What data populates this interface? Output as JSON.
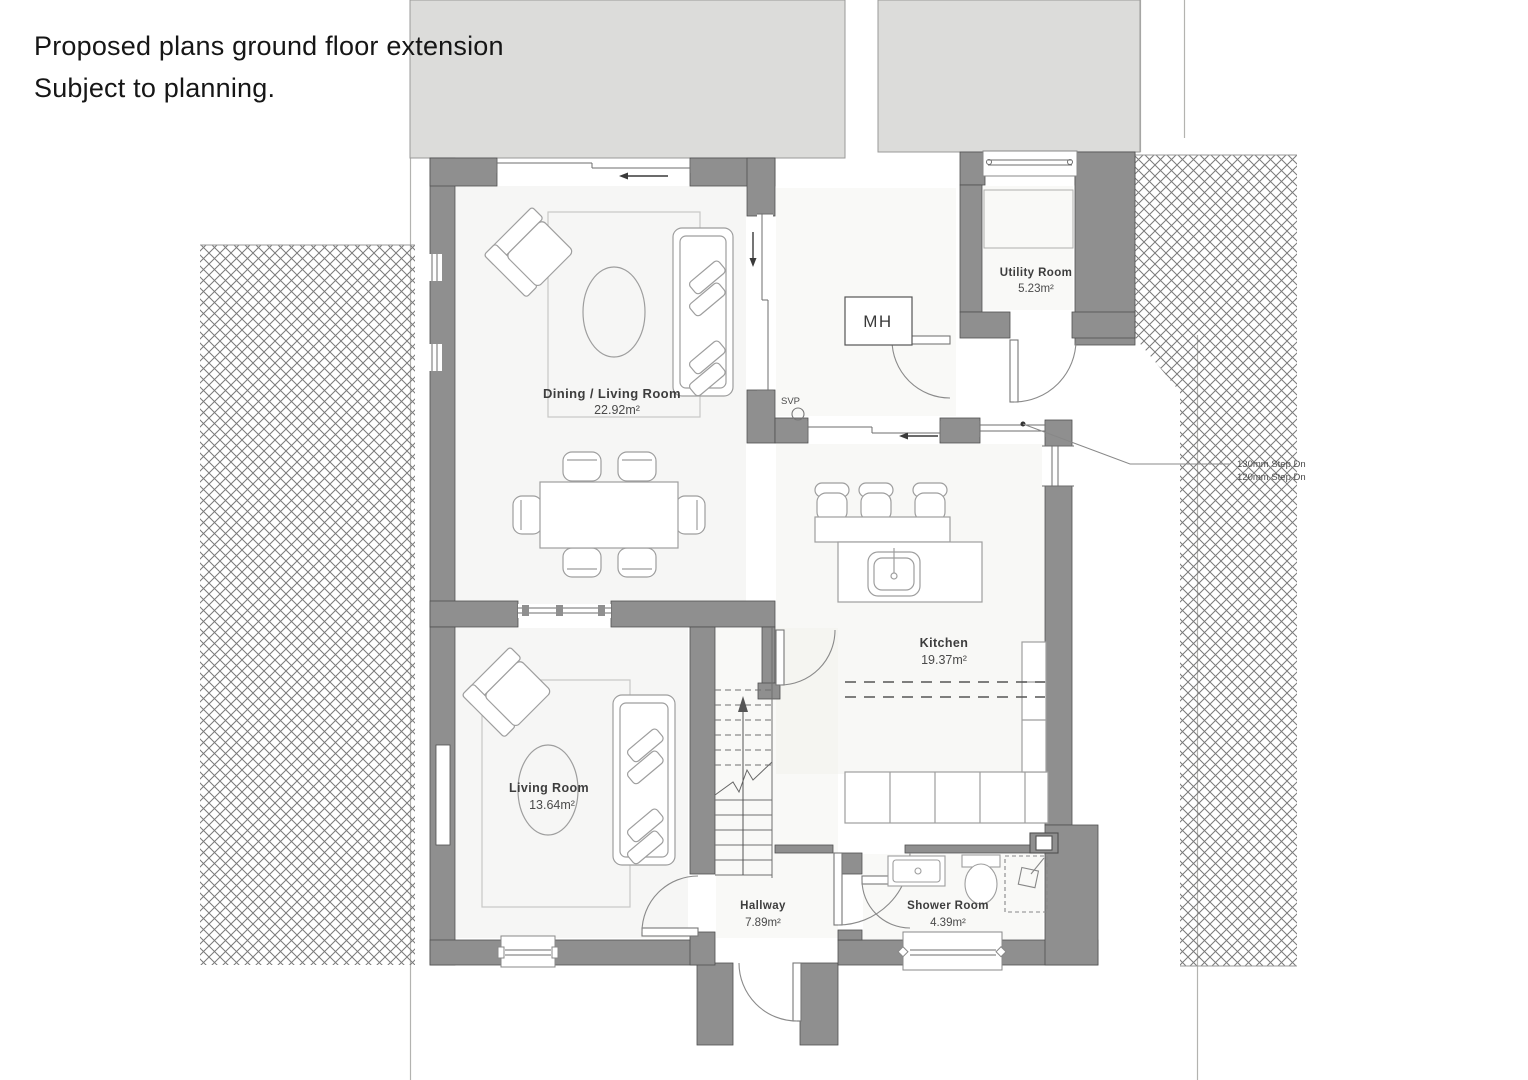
{
  "page": {
    "title_line1": "Proposed plans ground floor extension",
    "title_line2": "Subject to planning."
  },
  "rooms": [
    {
      "name": "Dining / Living Room",
      "area": "22.92m²"
    },
    {
      "name": "Utility Room",
      "area": "5.23m²"
    },
    {
      "name": "Kitchen",
      "area": "19.37m²"
    },
    {
      "name": "Living Room",
      "area": "13.64m²"
    },
    {
      "name": "Hallway",
      "area": "7.89m²"
    },
    {
      "name": "Shower Room",
      "area": "4.39m²"
    }
  ],
  "annotations": {
    "manhole": "MH",
    "soil_vent_pipe": "SVP",
    "step_note_line1": "130mm Step Dn",
    "step_note_line2": "120mm Step Dn"
  },
  "colors": {
    "wall_fill": "#8f8f8f",
    "wall_edge": "#4f4f4f",
    "adjacent_building_fill": "#dcdcda",
    "hatch_line": "#7a7a7a",
    "furniture_line": "#9e9e9e",
    "label_text": "#3d3d3d"
  }
}
